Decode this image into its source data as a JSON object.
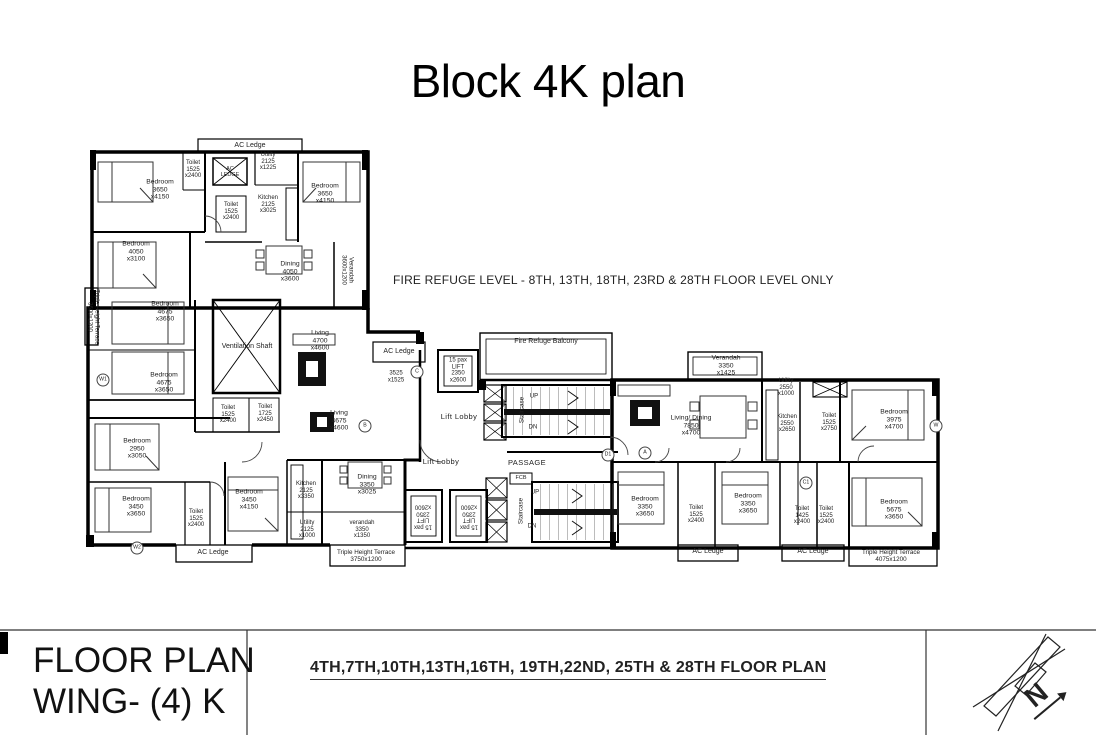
{
  "title": "Block 4K plan",
  "plan": {
    "fire_refuge_note": "FIRE REFUGE LEVEL - 8TH, 13TH, 18TH, 23RD & 28TH FLOOR LEVEL ONLY",
    "labels": [
      {
        "text": "AC Ledge"
      },
      {
        "text": "Bedroom\n3650\nx4150"
      },
      {
        "text": "Toilet\n1525\nx2400"
      },
      {
        "text": "AC\nLEDGE"
      },
      {
        "text": "Utility\n2125\nx1225"
      },
      {
        "text": "Kitchen\n2125\nx3025"
      },
      {
        "text": "Toilet\n1525\nx2400"
      },
      {
        "text": "Bedroom\n3650\nx4150"
      },
      {
        "text": "Bedroom\n4050\nx3100"
      },
      {
        "text": "Dining\n4050\nx3600"
      },
      {
        "text": "Verandah\n3600x1200"
      },
      {
        "text": "Triple Height Terrace\n3600x1200"
      },
      {
        "text": "Bedroom\n4675\nx3650"
      },
      {
        "text": "Ventilation Shaft"
      },
      {
        "text": "Living\n4700\nx4600"
      },
      {
        "text": "Bedroom\n4675\nx3650"
      },
      {
        "text": "Toilet\n1525\nx2400"
      },
      {
        "text": "Toilet\n1725\nx2450"
      },
      {
        "text": "Living\n4675\nx4600"
      },
      {
        "text": "Bedroom\n2950\nx3050"
      },
      {
        "text": "Bedroom\n3450\nx3650"
      },
      {
        "text": "Toilet\n1525\nx2400"
      },
      {
        "text": "Bedroom\n3450\nx4150"
      },
      {
        "text": "Kitchen\n2125\nx3350"
      },
      {
        "text": "Utility\n2125\nx1000"
      },
      {
        "text": "Dining\n3350\nx3025"
      },
      {
        "text": "verandah\n3350\nx1350"
      },
      {
        "text": "Triple Height Terrace\n3750x1200"
      },
      {
        "text": "AC Ledge"
      },
      {
        "text": "AC Ledge"
      },
      {
        "text": "3525\nx1525"
      },
      {
        "text": "15 pax\nLIFT\n2350\nx2600"
      },
      {
        "text": "Fire Refuge Balcony"
      },
      {
        "text": "Lift Lobby"
      },
      {
        "text": "Staircase"
      },
      {
        "text": "UP"
      },
      {
        "text": "DN"
      },
      {
        "text": "Lift Lobby"
      },
      {
        "text": "PASSAGE"
      },
      {
        "text": "15 pax\nLIFT\n2350\nx2600"
      },
      {
        "text": "15 pax\nLIFT\n2350\nx2600"
      },
      {
        "text": "Staircase"
      },
      {
        "text": "UP"
      },
      {
        "text": "DN"
      },
      {
        "text": "FCB"
      },
      {
        "text": "Verandah\n3350\nx1425"
      },
      {
        "text": "Living/ Dining\n7850\nx4700"
      },
      {
        "text": "Utility\n2550\nx1000"
      },
      {
        "text": "Kitchen\n2550\nx2650"
      },
      {
        "text": "Toilet\n1525\nx2750"
      },
      {
        "text": "Bedroom\n3975\nx4700"
      },
      {
        "text": "Bedroom\n3350\nx3650"
      },
      {
        "text": "Toilet\n1525\nx2400"
      },
      {
        "text": "Bedroom\n3350\nx3650"
      },
      {
        "text": "Toilet\n1425\nx2400"
      },
      {
        "text": "Toilet\n1525\nx2400"
      },
      {
        "text": "Bedroom\n5675\nx3650"
      },
      {
        "text": "AC Ledge"
      },
      {
        "text": "AC Ledge"
      },
      {
        "text": "Triple Height Terrace\n4075x1200"
      }
    ],
    "markers": [
      {
        "text": "B"
      },
      {
        "text": "C"
      },
      {
        "text": "D1"
      },
      {
        "text": "A"
      },
      {
        "text": "C1"
      },
      {
        "text": "W1"
      },
      {
        "text": "W2"
      },
      {
        "text": "W"
      }
    ]
  },
  "title_block": {
    "project_line1": "FLOOR PLAN",
    "project_line2": "WING- (4) K",
    "floors": "4TH,7TH,10TH,13TH,16TH, 19TH,22ND, 25TH & 28TH FLOOR PLAN",
    "north_label": "N"
  },
  "colors": {
    "ink": "#1f1f1f",
    "wall": "#000000",
    "paper": "#ffffff"
  }
}
